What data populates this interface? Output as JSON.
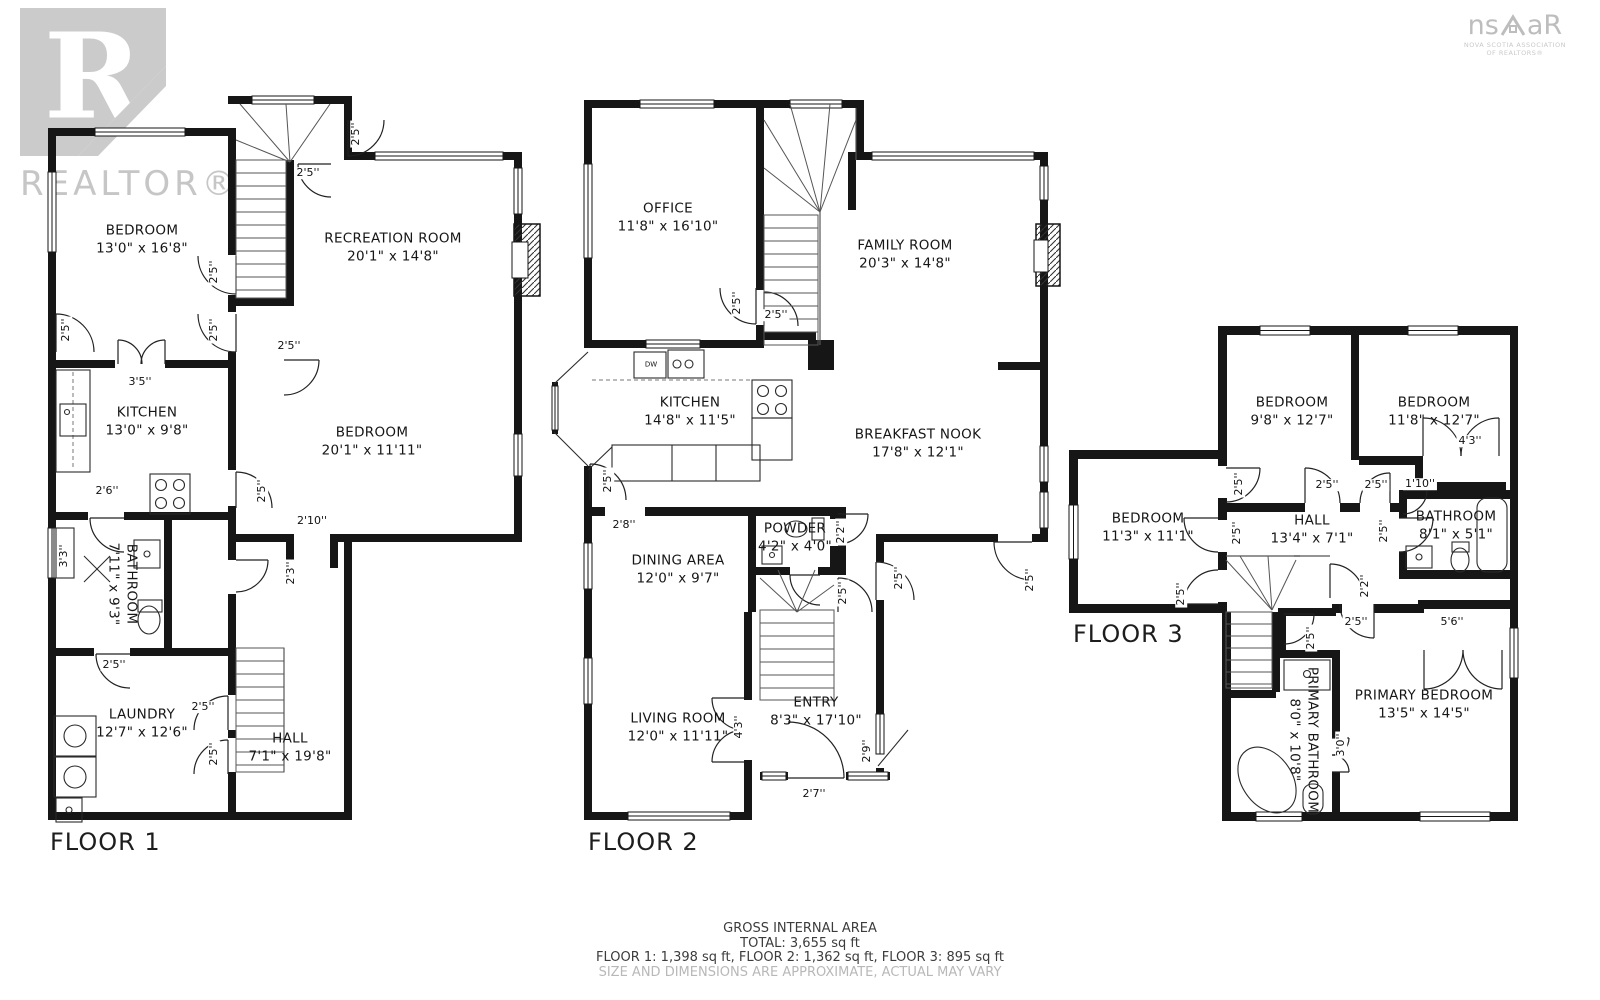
{
  "watermark": {
    "logo_letter": "R",
    "brand": "REALTOR®"
  },
  "association_logo": {
    "brand_left": "ns",
    "brand_right": "aR",
    "subtitle_line1": "NOVA SCOTIA ASSOCIATION",
    "subtitle_line2": "OF REALTORS®"
  },
  "footer": {
    "line1": "GROSS INTERNAL AREA",
    "line2": "TOTAL: 3,655 sq ft",
    "line3": "FLOOR 1: 1,398 sq ft, FLOOR 2: 1,362 sq ft, FLOOR 3: 895 sq ft",
    "line4": "SIZE AND DIMENSIONS ARE APPROXIMATE, ACTUAL MAY VARY"
  },
  "floors": [
    {
      "label": "FLOOR 1",
      "rooms": [
        {
          "name": "BEDROOM",
          "dims": "13'0\" x 16'8\""
        },
        {
          "name": "RECREATION ROOM",
          "dims": "20'1\" x 14'8\""
        },
        {
          "name": "KITCHEN",
          "dims": "13'0\" x 9'8\""
        },
        {
          "name": "BEDROOM",
          "dims": "20'1\" x 11'11\""
        },
        {
          "name": "BATHROOM",
          "dims": "7'11\" x 9'3\""
        },
        {
          "name": "LAUNDRY",
          "dims": "12'7\" x 12'6\""
        },
        {
          "name": "HALL",
          "dims": "7'1\" x 19'8\""
        }
      ],
      "dim_labels": [
        "2'5''",
        "2'5''",
        "2'5''",
        "2'5''",
        "2'5''",
        "2'5''",
        "3'5''",
        "2'6''",
        "2'5''",
        "2'10''",
        "2'3''",
        "3'3''",
        "2'5''",
        "2'5''",
        "2'5''"
      ]
    },
    {
      "label": "FLOOR 2",
      "rooms": [
        {
          "name": "OFFICE",
          "dims": "11'8\" x 16'10\""
        },
        {
          "name": "FAMILY ROOM",
          "dims": "20'3\" x 14'8\""
        },
        {
          "name": "KITCHEN",
          "dims": "14'8\" x 11'5\""
        },
        {
          "name": "BREAKFAST NOOK",
          "dims": "17'8\" x 12'1\""
        },
        {
          "name": "POWDER",
          "dims": "4'2\" x 4'0\""
        },
        {
          "name": "DINING AREA",
          "dims": "12'0\" x 9'7\""
        },
        {
          "name": "LIVING ROOM",
          "dims": "12'0\" x 11'11\""
        },
        {
          "name": "ENTRY",
          "dims": "8'3\" x 17'10\""
        }
      ],
      "dim_labels": [
        "2'5''",
        "2'5''",
        "2'5''",
        "2'8''",
        "2'2''",
        "2'5''",
        "2'5''",
        "2'5''",
        "4'3''",
        "2'9''",
        "2'7''",
        "DW"
      ]
    },
    {
      "label": "FLOOR 3",
      "rooms": [
        {
          "name": "BEDROOM",
          "dims": "9'8\" x 12'7\""
        },
        {
          "name": "BEDROOM",
          "dims": "11'8\" x 12'7\""
        },
        {
          "name": "BEDROOM",
          "dims": "11'3\" x 11'1\""
        },
        {
          "name": "HALL",
          "dims": "13'4\" x 7'1\""
        },
        {
          "name": "BATHROOM",
          "dims": "8'1\" x 5'1\""
        },
        {
          "name": "PRIMARY BATHROOM",
          "dims": "8'0\" x 10'8\""
        },
        {
          "name": "PRIMARY BEDROOM",
          "dims": "13'5\" x 14'5\""
        }
      ],
      "dim_labels": [
        "2'5''",
        "2'5''",
        "2'5''",
        "1'10''",
        "4'3''",
        "2'5''",
        "2'5''",
        "2'5''",
        "2'2''",
        "2'5''",
        "2'5''",
        "5'6''",
        "3'0''"
      ]
    }
  ]
}
